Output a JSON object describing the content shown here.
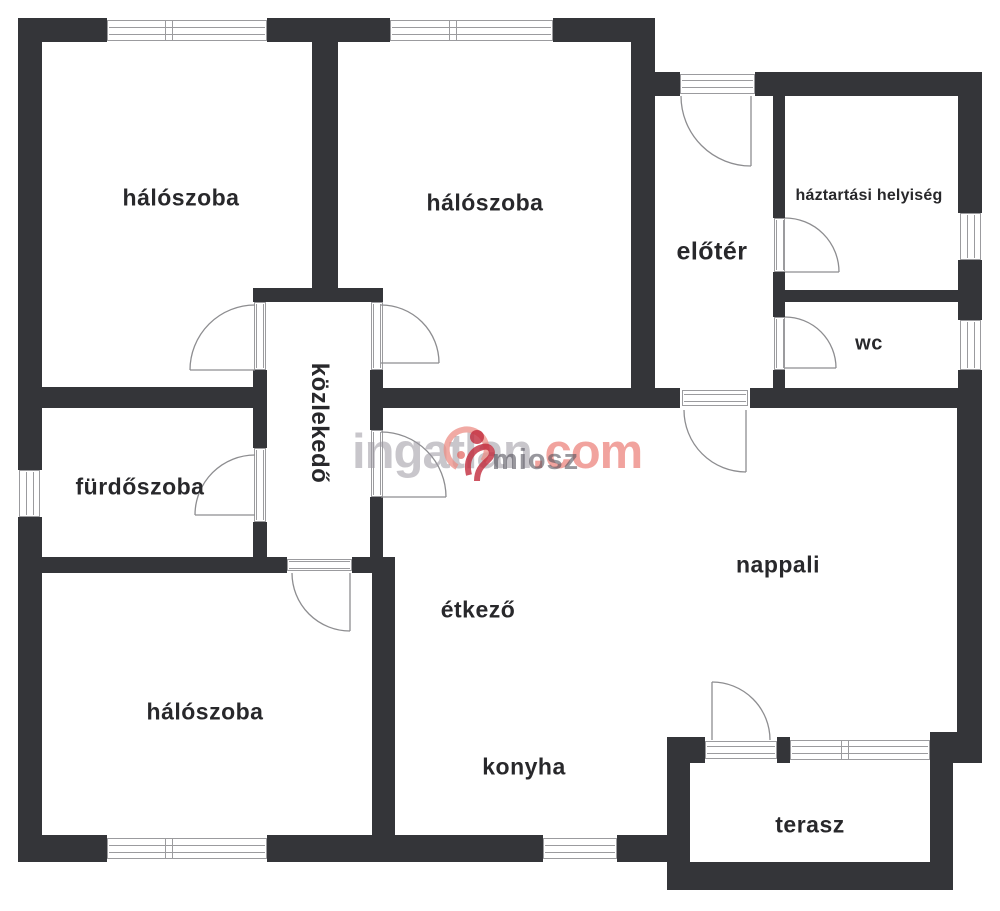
{
  "rooms": {
    "bedroom_top_left": {
      "label": "hálószoba"
    },
    "bedroom_top_middle": {
      "label": "hálószoba"
    },
    "bedroom_bottom_left": {
      "label": "hálószoba"
    },
    "foyer": {
      "label": "előtér"
    },
    "utility_room": {
      "label": "háztartási helyiség"
    },
    "wc": {
      "label": "wc"
    },
    "corridor": {
      "label": "közlekedő"
    },
    "bathroom": {
      "label": "fürdőszoba"
    },
    "living_room": {
      "label": "nappali"
    },
    "dining_room": {
      "label": "étkező"
    },
    "kitchen": {
      "label": "konyha"
    },
    "terrace": {
      "label": "terasz"
    }
  },
  "watermark": {
    "brand_gray": "ingatlan",
    "brand_red": ".com",
    "overlay": "miosz"
  },
  "colors": {
    "wall": "#343539",
    "label_text": "#28282b",
    "watermark_gray": "#b7b6ba",
    "watermark_red": "#ef8f8a",
    "logo_red": "#c22a3c",
    "logo_salmon": "#ec8d85"
  }
}
